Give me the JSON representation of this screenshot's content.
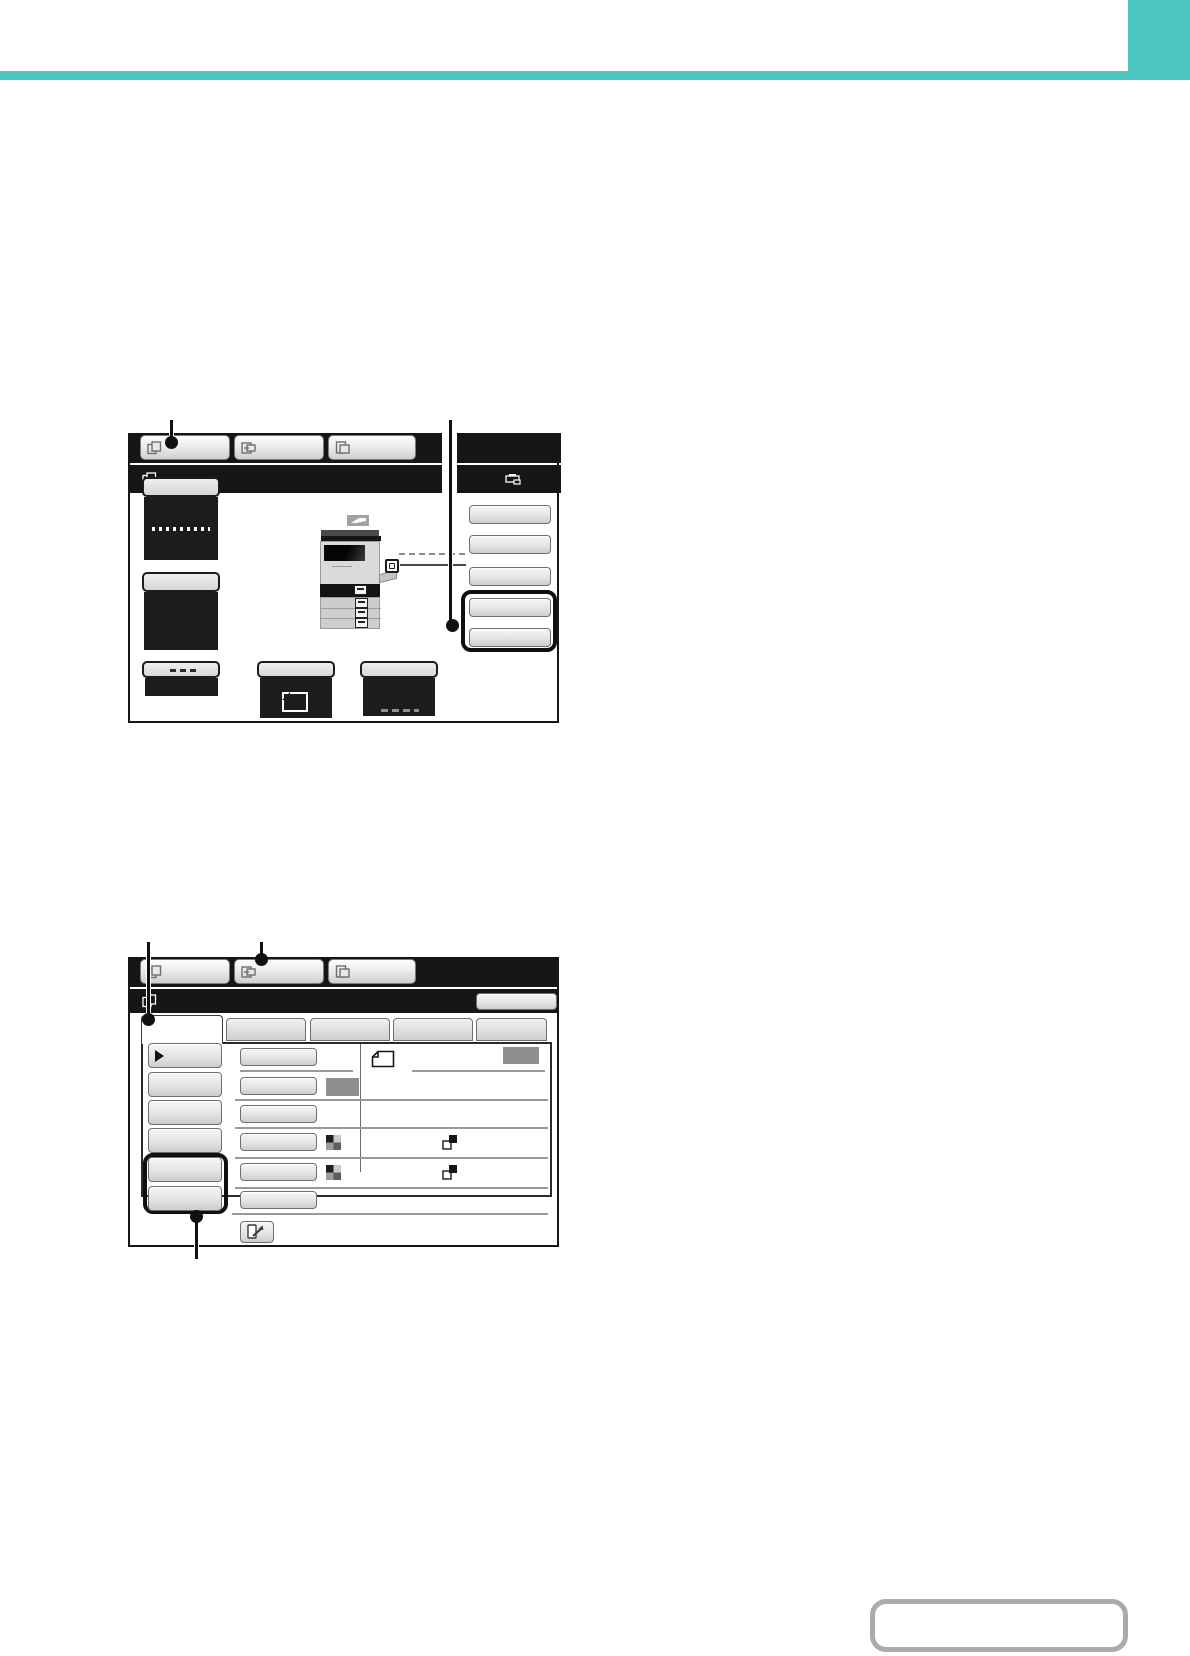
{
  "page": {
    "kind": "printer operation-manual page containing two blank touch-panel screenshots",
    "accent_teal": "#4cc7c2",
    "callout_black": "#101010",
    "highlight_outline": "#101010",
    "swatch_gray": "#8f8f8f",
    "note_box_border": "#ababab"
  },
  "screenshot1": {
    "mode_tab_bar": {
      "tabs": [
        {
          "icon": "copy-icon",
          "label": ""
        },
        {
          "icon": "image-send-icon",
          "label": ""
        },
        {
          "icon": "document-filing-icon",
          "label": ""
        }
      ]
    },
    "title_bar": {
      "icon": "copy-icon",
      "title": ""
    },
    "job_status_panel": {
      "header_icon": "printer-icon",
      "buttons": [
        "",
        "",
        "",
        "",
        ""
      ],
      "highlighted_button_indexes": [
        3,
        4
      ]
    },
    "left_panel": {
      "top_buttons": [
        "",
        ""
      ],
      "bottom_buttons": [
        "",
        "",
        ""
      ],
      "machine_graphic": "multifunction-printer-illustration"
    },
    "callouts": [
      {
        "points_to": "first mode tab"
      },
      {
        "points_to": "two highlighted job-status buttons"
      }
    ]
  },
  "screenshot2": {
    "mode_tab_bar": {
      "tabs": [
        {
          "icon": "copy-icon",
          "label": ""
        },
        {
          "icon": "image-send-icon",
          "label": ""
        },
        {
          "icon": "document-filing-icon",
          "label": ""
        }
      ]
    },
    "title_bar": {
      "icon": "copy-icon",
      "title": "",
      "right_button_label": ""
    },
    "page_tabs": [
      "",
      "",
      "",
      "",
      ""
    ],
    "selected_page_tab_index": 0,
    "left_menu": {
      "buttons": [
        "",
        "",
        "",
        "",
        "",
        ""
      ],
      "first_button_icon": "play-arrow-icon",
      "highlighted_button_indexes": [
        4,
        5
      ]
    },
    "settings_rows": [
      {
        "button": "",
        "icons": [
          "sheet-icon"
        ],
        "right_swatch": true
      },
      {
        "button": "",
        "icons": [],
        "inline_swatch": true
      },
      {
        "button": "",
        "icons": []
      },
      {
        "button": "",
        "icons": [
          "checker-icon",
          "overlap-squares-icon"
        ]
      },
      {
        "button": "",
        "icons": [
          "checker-icon",
          "overlap-squares-icon"
        ]
      },
      {
        "button": "",
        "icons": []
      }
    ],
    "footer_button_icon": "expand-icon",
    "callouts": [
      {
        "points_to": "selected page tab"
      },
      {
        "points_to": "second mode tab"
      },
      {
        "points_to": "two highlighted left-menu buttons"
      }
    ]
  },
  "note_box": {
    "text": ""
  }
}
